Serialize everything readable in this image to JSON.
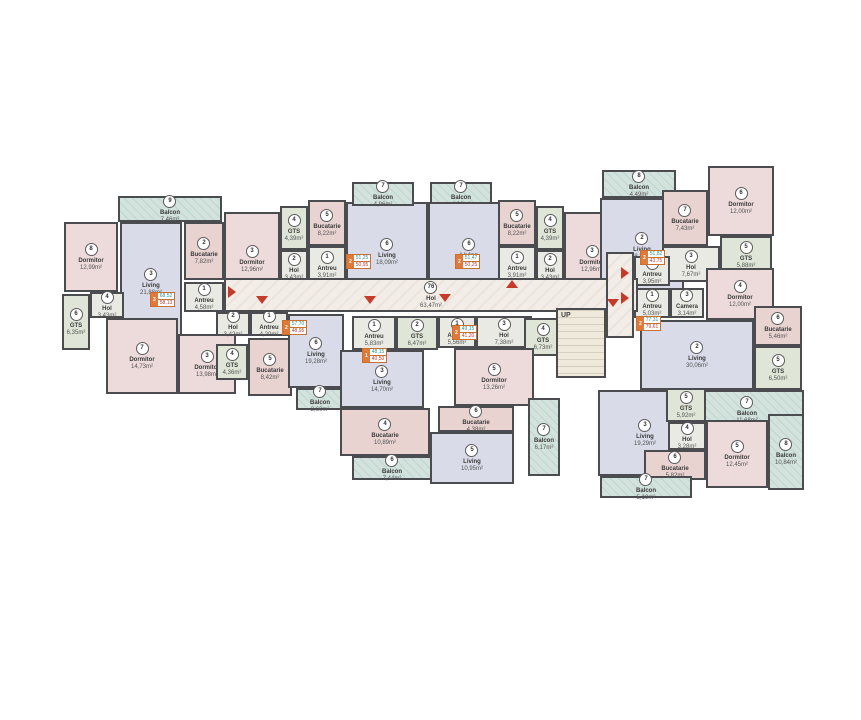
{
  "meta": {
    "drawing_type": "apartment-building-floor-plan",
    "background": "#ffffff"
  },
  "palette": {
    "wall": "#4b4c50",
    "bedroom": "#eddbdb",
    "kitchen": "#e9d3d1",
    "living": "#d9dbe8",
    "bath": "#dfe6d8",
    "hall": "#e9eae3",
    "balcony": "#d2e2dc",
    "corridor": "#f2ede7",
    "stairs": "#efe9dc",
    "arrow": "#c63a2a",
    "tag": "#e0793a"
  },
  "floorplan": {
    "stairs_label": "UP",
    "rooms": [
      {
        "n": "9",
        "name": "Balcon",
        "area": "7,46m²",
        "t": "balcony",
        "x": 118,
        "y": 196,
        "w": 104,
        "h": 26
      },
      {
        "n": "8",
        "name": "Dormitor",
        "area": "12,99m²",
        "t": "bedroom",
        "x": 64,
        "y": 222,
        "w": 54,
        "h": 70
      },
      {
        "n": "3",
        "name": "Living",
        "area": "21,88m²",
        "t": "living",
        "x": 120,
        "y": 222,
        "w": 62,
        "h": 120
      },
      {
        "n": "2",
        "name": "Bucatarie",
        "area": "7,82m²",
        "t": "kitchen",
        "x": 184,
        "y": 222,
        "w": 40,
        "h": 58
      },
      {
        "n": "1",
        "name": "Antreu",
        "area": "4,58m²",
        "t": "hall",
        "x": 184,
        "y": 282,
        "w": 40,
        "h": 30
      },
      {
        "n": "4",
        "name": "Hol",
        "area": "3,43m²",
        "t": "hall",
        "x": 90,
        "y": 292,
        "w": 34,
        "h": 26
      },
      {
        "n": "6",
        "name": "GTS",
        "area": "6,35m²",
        "t": "bath",
        "x": 62,
        "y": 294,
        "w": 28,
        "h": 56
      },
      {
        "n": "7",
        "name": "Dormitor",
        "area": "14,73m²",
        "t": "bedroom",
        "x": 106,
        "y": 318,
        "w": 72,
        "h": 76
      },
      {
        "n": "3",
        "name": "Dormitor",
        "area": "13,98m²",
        "t": "bedroom",
        "x": 178,
        "y": 334,
        "w": 58,
        "h": 60
      },
      {
        "n": "2",
        "name": "Hol",
        "area": "3,42m²",
        "t": "hall",
        "x": 216,
        "y": 312,
        "w": 34,
        "h": 24
      },
      {
        "n": "1",
        "name": "Antreu",
        "area": "4,20m²",
        "t": "hall",
        "x": 250,
        "y": 312,
        "w": 38,
        "h": 24
      },
      {
        "n": "4",
        "name": "GTS",
        "area": "4,36m²",
        "t": "bath",
        "x": 216,
        "y": 344,
        "w": 32,
        "h": 36
      },
      {
        "n": "5",
        "name": "Bucatarie",
        "area": "8,42m²",
        "t": "kitchen",
        "x": 248,
        "y": 338,
        "w": 44,
        "h": 58
      },
      {
        "n": "6",
        "name": "Living",
        "area": "19,28m²",
        "t": "living",
        "x": 288,
        "y": 314,
        "w": 56,
        "h": 74
      },
      {
        "n": "7",
        "name": "Balcon",
        "area": "3,60m²",
        "t": "balcony",
        "x": 296,
        "y": 388,
        "w": 48,
        "h": 22
      },
      {
        "n": "3",
        "name": "Dormitor",
        "area": "12,96m²",
        "t": "bedroom",
        "x": 224,
        "y": 212,
        "w": 56,
        "h": 94
      },
      {
        "n": "4",
        "name": "GTS",
        "area": "4,39m²",
        "t": "bath",
        "x": 280,
        "y": 206,
        "w": 28,
        "h": 44
      },
      {
        "n": "5",
        "name": "Bucatarie",
        "area": "8,22m²",
        "t": "kitchen",
        "x": 308,
        "y": 200,
        "w": 38,
        "h": 46
      },
      {
        "n": "2",
        "name": "Hol",
        "area": "3,43m²",
        "t": "hall",
        "x": 280,
        "y": 250,
        "w": 28,
        "h": 34
      },
      {
        "n": "1",
        "name": "Antreu",
        "area": "3,91m²",
        "t": "hall",
        "x": 308,
        "y": 246,
        "w": 38,
        "h": 38
      },
      {
        "n": "6",
        "name": "Living",
        "area": "18,09m²",
        "t": "living",
        "x": 346,
        "y": 202,
        "w": 82,
        "h": 100
      },
      {
        "n": "7",
        "name": "Balcon",
        "area": "4,96m²",
        "t": "balcony",
        "x": 352,
        "y": 182,
        "w": 62,
        "h": 24
      },
      {
        "n": "7",
        "name": "Balcon",
        "area": "4,96m²",
        "t": "balcony",
        "x": 430,
        "y": 182,
        "w": 62,
        "h": 24
      },
      {
        "n": "6",
        "name": "Living",
        "area": "19,49m²",
        "t": "living",
        "x": 428,
        "y": 202,
        "w": 82,
        "h": 100
      },
      {
        "n": "1",
        "name": "Antreu",
        "area": "3,91m²",
        "t": "hall",
        "x": 498,
        "y": 246,
        "w": 38,
        "h": 38
      },
      {
        "n": "5",
        "name": "Bucatarie",
        "area": "8,22m²",
        "t": "kitchen",
        "x": 498,
        "y": 200,
        "w": 38,
        "h": 46
      },
      {
        "n": "4",
        "name": "GTS",
        "area": "4,39m²",
        "t": "bath",
        "x": 536,
        "y": 206,
        "w": 28,
        "h": 44
      },
      {
        "n": "2",
        "name": "Hol",
        "area": "3,43m²",
        "t": "hall",
        "x": 536,
        "y": 250,
        "w": 28,
        "h": 34
      },
      {
        "n": "3",
        "name": "Dormitor",
        "area": "12,96m²",
        "t": "bedroom",
        "x": 564,
        "y": 212,
        "w": 56,
        "h": 94
      },
      {
        "n": "8",
        "name": "Balcon",
        "area": "4,49m²",
        "t": "balcony",
        "x": 602,
        "y": 170,
        "w": 74,
        "h": 28
      },
      {
        "n": "2",
        "name": "Living",
        "area": "18,25m²",
        "t": "living",
        "x": 600,
        "y": 198,
        "w": 84,
        "h": 96
      },
      {
        "n": "7",
        "name": "Bucatarie",
        "area": "7,43m²",
        "t": "kitchen",
        "x": 662,
        "y": 190,
        "w": 46,
        "h": 56
      },
      {
        "n": "6",
        "name": "Dormitor",
        "area": "12,00m²",
        "t": "bedroom",
        "x": 708,
        "y": 166,
        "w": 66,
        "h": 70
      },
      {
        "n": "5",
        "name": "GTS",
        "area": "5,88m²",
        "t": "bath",
        "x": 720,
        "y": 236,
        "w": 52,
        "h": 38
      },
      {
        "n": "3",
        "name": "Hol",
        "area": "7,67m²",
        "t": "hall",
        "x": 662,
        "y": 246,
        "w": 58,
        "h": 36
      },
      {
        "n": "4",
        "name": "Dormitor",
        "area": "12,00m²",
        "t": "bedroom",
        "x": 706,
        "y": 268,
        "w": 68,
        "h": 52
      },
      {
        "n": "1",
        "name": "Antreu",
        "area": "3,95m²",
        "t": "hall",
        "x": 634,
        "y": 256,
        "w": 36,
        "h": 30
      },
      {
        "n": "1",
        "name": "Antreu",
        "area": "5,03m²",
        "t": "hall",
        "x": 634,
        "y": 288,
        "w": 36,
        "h": 30
      },
      {
        "n": "3",
        "name": "Camera",
        "area": "3,14m²",
        "t": "hall",
        "x": 670,
        "y": 288,
        "w": 34,
        "h": 30
      },
      {
        "n": "2",
        "name": "Living",
        "area": "30,06m²",
        "t": "living",
        "x": 640,
        "y": 320,
        "w": 114,
        "h": 70
      },
      {
        "n": "6",
        "name": "Bucatarie",
        "area": "5,46m²",
        "t": "kitchen",
        "x": 754,
        "y": 306,
        "w": 48,
        "h": 40
      },
      {
        "n": "5",
        "name": "GTS",
        "area": "6,50m²",
        "t": "bath",
        "x": 754,
        "y": 346,
        "w": 48,
        "h": 44
      },
      {
        "n": "7",
        "name": "Balcon",
        "area": "11,68m²",
        "t": "balcony",
        "x": 690,
        "y": 390,
        "w": 114,
        "h": 40
      },
      {
        "n": "3",
        "name": "Living",
        "area": "19,29m²",
        "t": "living",
        "x": 598,
        "y": 390,
        "w": 94,
        "h": 86
      },
      {
        "n": "5",
        "name": "GTS",
        "area": "5,92m²",
        "t": "bath",
        "x": 666,
        "y": 388,
        "w": 40,
        "h": 34
      },
      {
        "n": "4",
        "name": "Hol",
        "area": "3,28m²",
        "t": "hall",
        "x": 668,
        "y": 422,
        "w": 38,
        "h": 28
      },
      {
        "n": "6",
        "name": "Bucatarie",
        "area": "5,82m²",
        "t": "kitchen",
        "x": 644,
        "y": 450,
        "w": 62,
        "h": 30
      },
      {
        "n": "5",
        "name": "Dormitor",
        "area": "12,45m²",
        "t": "bedroom",
        "x": 706,
        "y": 420,
        "w": 62,
        "h": 68
      },
      {
        "n": "8",
        "name": "Balcon",
        "area": "10,84m²",
        "t": "balcony",
        "x": 768,
        "y": 414,
        "w": 36,
        "h": 76
      },
      {
        "n": "7",
        "name": "Balcon",
        "area": "5,19m²",
        "t": "balcony",
        "x": 600,
        "y": 476,
        "w": 92,
        "h": 22
      },
      {
        "n": "1",
        "name": "Antreu",
        "area": "5,83m²",
        "t": "hall",
        "x": 352,
        "y": 316,
        "w": 44,
        "h": 34
      },
      {
        "n": "2",
        "name": "GTS",
        "area": "6,47m²",
        "t": "bath",
        "x": 396,
        "y": 316,
        "w": 42,
        "h": 34
      },
      {
        "n": "3",
        "name": "Living",
        "area": "14,70m²",
        "t": "living",
        "x": 340,
        "y": 350,
        "w": 84,
        "h": 58
      },
      {
        "n": "4",
        "name": "Bucatarie",
        "area": "10,89m²",
        "t": "kitchen",
        "x": 340,
        "y": 408,
        "w": 90,
        "h": 48
      },
      {
        "n": "6",
        "name": "Balcon",
        "area": "7,44m²",
        "t": "balcony",
        "x": 352,
        "y": 456,
        "w": 80,
        "h": 24
      },
      {
        "n": "1",
        "name": "Antreu",
        "area": "5,56m²",
        "t": "hall",
        "x": 438,
        "y": 316,
        "w": 38,
        "h": 32
      },
      {
        "n": "3",
        "name": "Hol",
        "area": "7,38m²",
        "t": "hall",
        "x": 476,
        "y": 316,
        "w": 56,
        "h": 32
      },
      {
        "n": "4",
        "name": "GTS",
        "area": "6,73m²",
        "t": "bath",
        "x": 524,
        "y": 318,
        "w": 38,
        "h": 38
      },
      {
        "n": "5",
        "name": "Dormitor",
        "area": "13,26m²",
        "t": "bedroom",
        "x": 454,
        "y": 348,
        "w": 80,
        "h": 58
      },
      {
        "n": "6",
        "name": "Bucatarie",
        "area": "4,38m²",
        "t": "kitchen",
        "x": 438,
        "y": 406,
        "w": 76,
        "h": 26
      },
      {
        "n": "5",
        "name": "Living",
        "area": "10,95m²",
        "t": "living",
        "x": 430,
        "y": 432,
        "w": 84,
        "h": 52
      },
      {
        "n": "7",
        "name": "Balcon",
        "area": "6,17m²",
        "t": "balcony",
        "x": 528,
        "y": 398,
        "w": 32,
        "h": 78
      },
      {
        "n": "76",
        "name": "Hol",
        "area": "63,47m²",
        "t": "corridor",
        "x": 224,
        "y": 278,
        "w": 414,
        "h": 34
      },
      {
        "n": "",
        "name": "",
        "area": "",
        "t": "corridor",
        "x": 606,
        "y": 252,
        "w": 28,
        "h": 86
      },
      {
        "n": "",
        "name": "",
        "area": "",
        "t": "stairs",
        "x": 556,
        "y": 308,
        "w": 50,
        "h": 70
      }
    ],
    "arrows": [
      {
        "dir": "right",
        "x": 228,
        "y": 286
      },
      {
        "dir": "down",
        "x": 256,
        "y": 296
      },
      {
        "dir": "down",
        "x": 364,
        "y": 296
      },
      {
        "dir": "down",
        "x": 439,
        "y": 294
      },
      {
        "dir": "up",
        "x": 506,
        "y": 280
      },
      {
        "dir": "right",
        "x": 621,
        "y": 267
      },
      {
        "dir": "right",
        "x": 621,
        "y": 292
      },
      {
        "dir": "down",
        "x": 607,
        "y": 299
      }
    ],
    "tags": [
      {
        "num": "3",
        "top": "68,52",
        "bot": "58,13",
        "x": 150,
        "y": 292
      },
      {
        "num": "2",
        "top": "57,70",
        "bot": "48,95",
        "x": 282,
        "y": 320
      },
      {
        "num": "2",
        "top": "51,25",
        "bot": "50,95",
        "x": 346,
        "y": 254
      },
      {
        "num": "2",
        "top": "51,47",
        "bot": "50,25",
        "x": 455,
        "y": 254
      },
      {
        "num": "1",
        "top": "48,15",
        "bot": "40,50",
        "x": 362,
        "y": 348
      },
      {
        "num": "2",
        "top": "49,15",
        "bot": "41,20",
        "x": 452,
        "y": 325
      },
      {
        "num": "2",
        "top": "77,31",
        "bot": "79,61",
        "x": 636,
        "y": 316
      },
      {
        "num": "2",
        "top": "51,82",
        "bot": "43,75",
        "x": 640,
        "y": 250
      }
    ]
  }
}
